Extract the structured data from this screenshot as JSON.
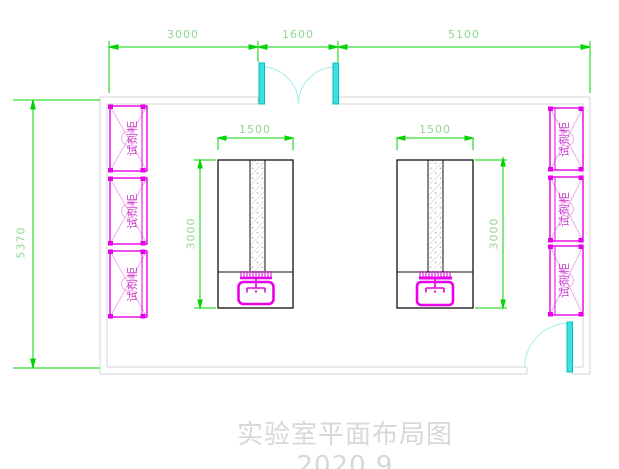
{
  "title": "实验室平面布局图2020.9",
  "dimensions": {
    "top_segments": [
      "3000",
      "1600",
      "5100"
    ],
    "room_height": "5370",
    "bench_width_left": "1500",
    "bench_width_right": "1500",
    "bench_depth_left": "3000",
    "bench_depth_right": "3000"
  },
  "cabinets": {
    "left": [
      "试剂柜",
      "试剂柜",
      "试剂柜"
    ],
    "right": [
      "试剂柜",
      "试剂柜",
      "试剂柜"
    ]
  },
  "colors": {
    "dimension_line": "#00d400",
    "dimension_text": "#8fd88f",
    "cabinet_magenta": "#e800e8",
    "cabinet_light": "#f0a2f0",
    "door_cyan": "#00dcdc",
    "wall_gray": "#d6d6d6",
    "bench_outline": "#111111",
    "title_gray": "#d8d8d8"
  }
}
